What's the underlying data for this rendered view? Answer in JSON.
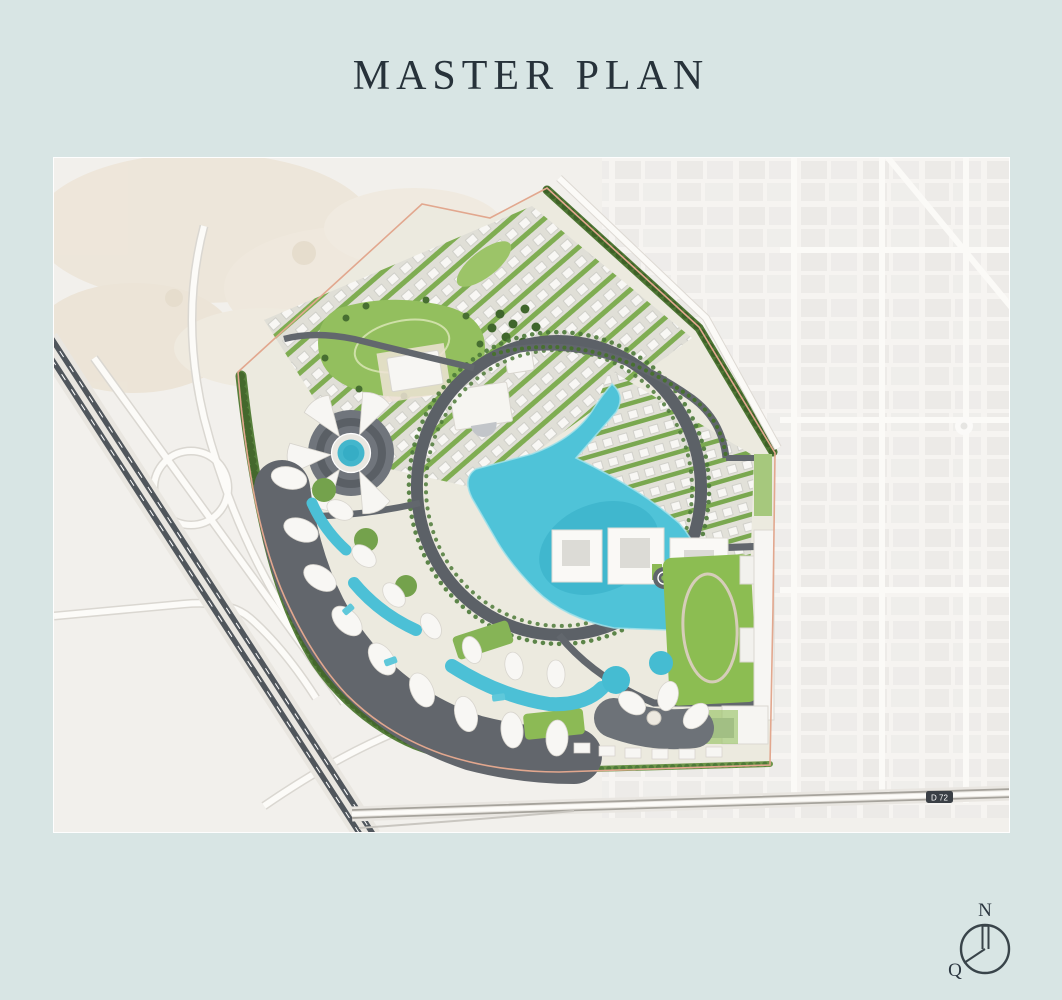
{
  "page": {
    "title": "MASTER PLAN",
    "background_color": "#d8e5e4",
    "title_color": "#27323a"
  },
  "map": {
    "kind": "master-plan-aerial-render",
    "road_badge": "D 72",
    "colors": {
      "lagoon": "#4fc3d8",
      "pool": "#4cc0d6",
      "site_tree_green": "#4b7434",
      "lawn_green": "#8cbd52",
      "road_dark": "#565b63",
      "podium_dark": "#60656e",
      "building_white": "#f6f5f2",
      "city_block": "#e5e4e1",
      "desert_sand": "#ece4d5",
      "site_boundary": "#e2a78e"
    }
  },
  "compass": {
    "north": "N",
    "qibla": "Q"
  }
}
